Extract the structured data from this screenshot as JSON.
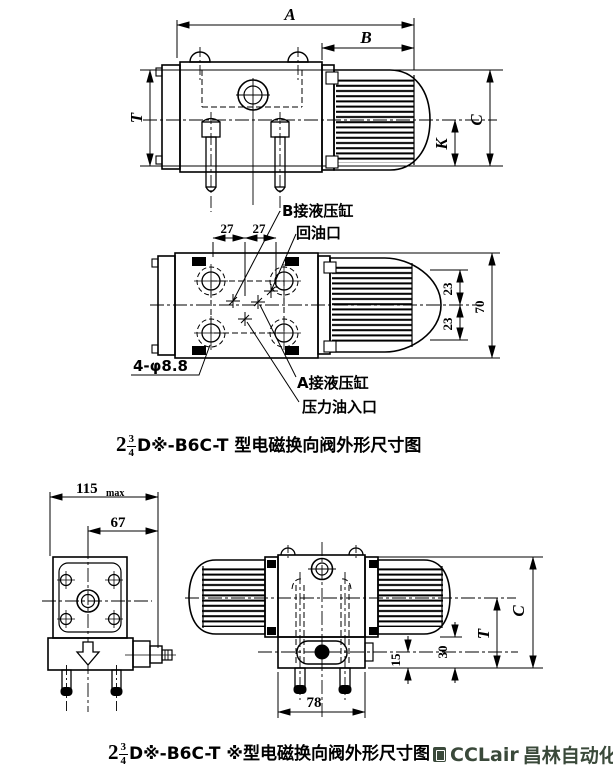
{
  "colors": {
    "background": "#ffffff",
    "line": "#000000",
    "watermark": "#3a493a"
  },
  "side_view": {
    "dim_A": "A",
    "dim_B": "B",
    "dim_T": "T",
    "dim_C": "C",
    "dim_K": "K"
  },
  "plan_view": {
    "dim_27_left": "27",
    "dim_27_right": "27",
    "dim_23_upper": "23",
    "dim_23_lower": "23",
    "dim_70": "70",
    "label_port_b": "B接液压缸",
    "label_return_port": "回油口",
    "label_mount_holes": "4-φ8.8",
    "label_port_a": "A接液压缸",
    "label_pressure_port": "压力油入口"
  },
  "front_view": {
    "dim_115": "115",
    "dim_115_suffix": "max",
    "dim_67": "67"
  },
  "double_view": {
    "dim_78": "78",
    "dim_15": "15",
    "dim_30": "30",
    "dim_T": "T",
    "dim_C": "C"
  },
  "captions": {
    "single_solenoid": {
      "coefficient": "2",
      "fraction_numerator": "3",
      "fraction_denominator": "4",
      "model_text": "D※-B6C-T 型电磁换向阀外形尺寸图"
    },
    "double_solenoid": {
      "coefficient": "2",
      "fraction_numerator": "3",
      "fraction_denominator": "4",
      "model_text": "D※-B6C-T ※型电磁换向阀外形尺寸图"
    }
  },
  "watermark": {
    "brand": "CCLair",
    "company": "昌林自动化"
  }
}
